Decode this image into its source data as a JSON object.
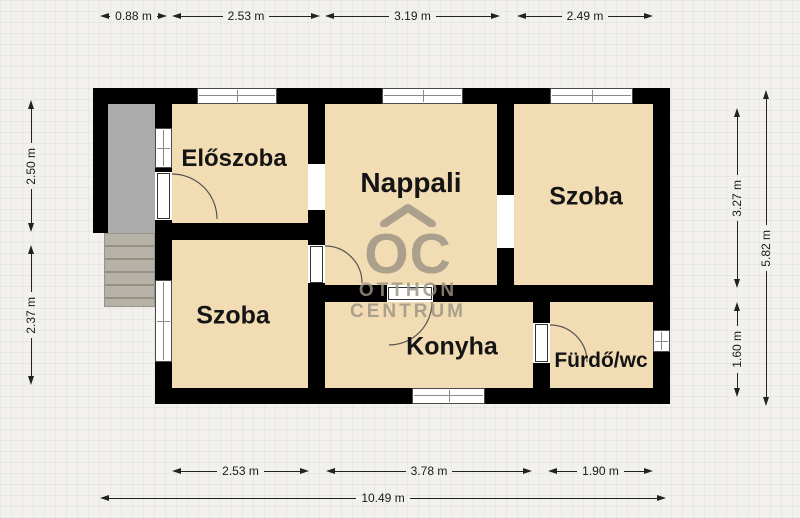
{
  "plan": {
    "rooms": {
      "eloszoba": "Előszoba",
      "nappali": "Nappali",
      "szoba_right": "Szoba",
      "szoba_left": "Szoba",
      "konyha": "Konyha",
      "furdo_wc": "Fürdő/wc"
    },
    "watermark": {
      "mark": "OC",
      "line1": "OTTHON",
      "line2": "CENTRUM"
    },
    "dimensions": {
      "top": [
        "0.88 m",
        "2.53 m",
        "3.19 m",
        "2.49 m"
      ],
      "bottom": [
        "2.53 m",
        "3.78 m",
        "1.90 m"
      ],
      "bottom_total": "10.49 m",
      "left": [
        "2.50 m",
        "2.37 m"
      ],
      "right": [
        "3.27 m",
        "1.60 m"
      ],
      "right_total": "5.82 m"
    },
    "colors": {
      "wall": "#000000",
      "room_fill": "#f2dcb3",
      "porch": "#ababab",
      "stairs": "#b6b2a7",
      "watermark": "#9b9383",
      "background": "#f2f1ee"
    }
  }
}
